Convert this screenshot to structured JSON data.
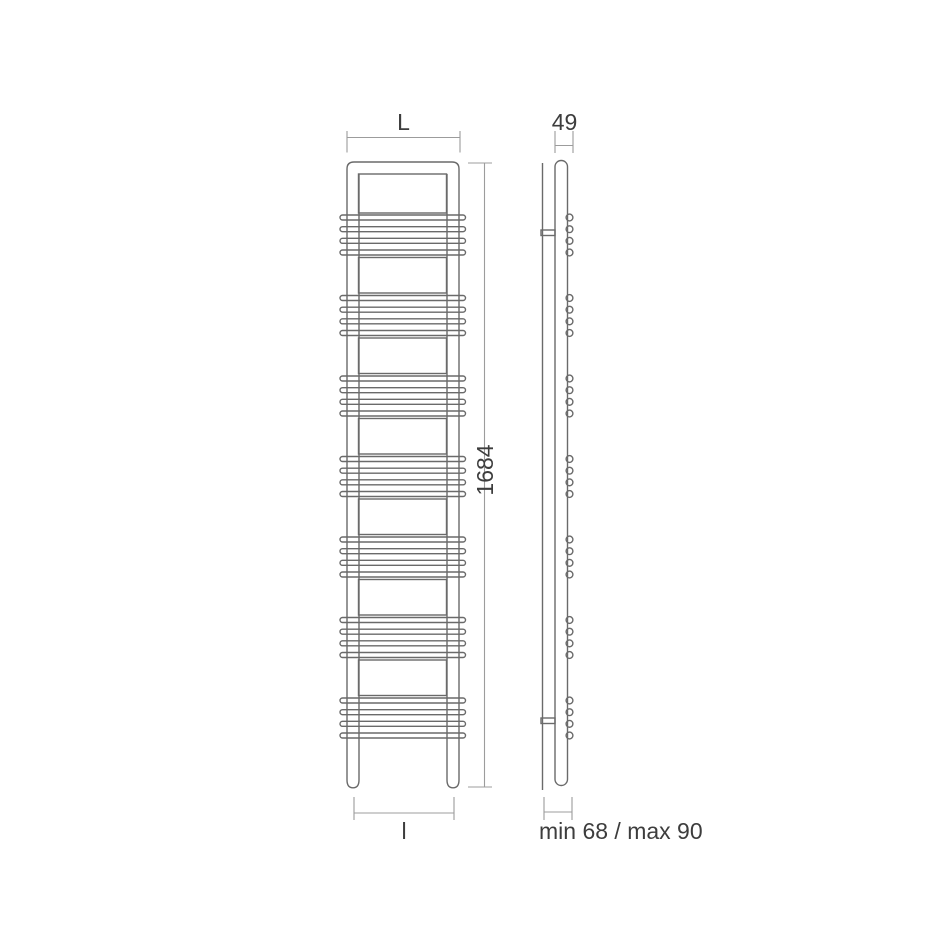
{
  "drawing": {
    "title": "towel-radiator-dimension-drawing",
    "front_view": {
      "width_label": "L",
      "height_label": "1684",
      "pipe_centres_label": "l"
    },
    "side_view": {
      "depth_label": "49",
      "wall_distance_label": "min 68 / max 90"
    }
  },
  "colors": {
    "line": "#6a6a6a",
    "dimension": "#9c9c9c",
    "text": "#3d3d3d",
    "background": "#ffffff"
  }
}
